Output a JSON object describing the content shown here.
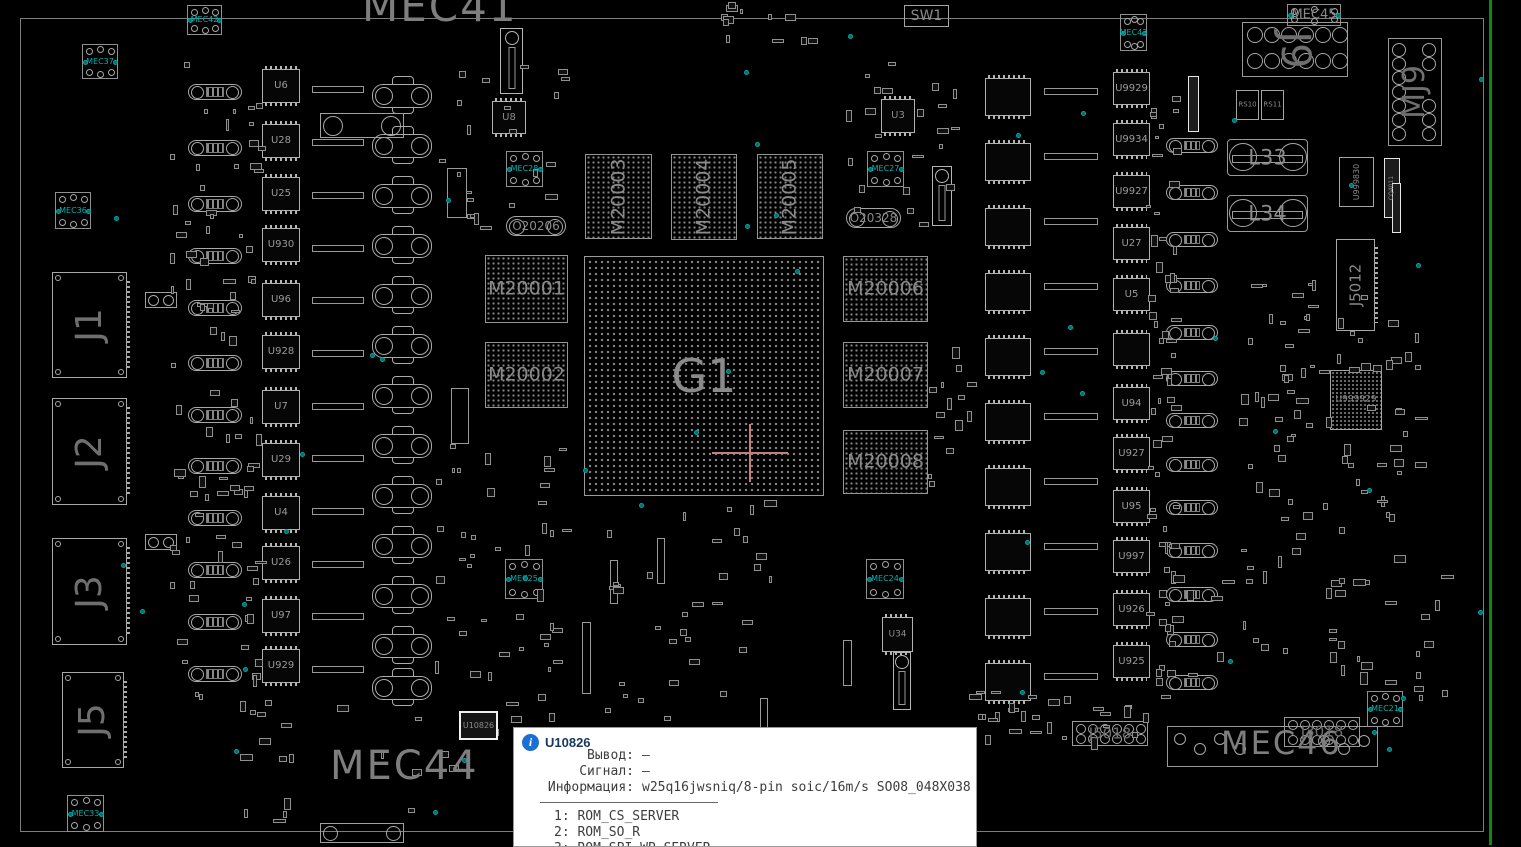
{
  "app": {
    "kind": "pcb-boardview-canvas"
  },
  "colors": {
    "background": "#000000",
    "silkscreen": "#7e7e7e",
    "component_outline": "#a8a8a8",
    "teal_marker": "#00b0b0",
    "board_edge_green": "#0c8a14",
    "crosshair": "#c47e7e",
    "tooltip_bg": "#ffffff",
    "tooltip_title": "#17375e",
    "info_icon_blue": "#1a6fd4"
  },
  "tooltip": {
    "ref": "U10826",
    "fields": [
      {
        "label": "Вывод:",
        "value": "—"
      },
      {
        "label": "Сигнал:",
        "value": "—"
      },
      {
        "label": "Информация:",
        "value": "w25q16jwsniq/8-pin soic/16m/s SO08_048X038"
      }
    ],
    "pins": [
      "1: ROM_CS_SERVER",
      "2: ROM_SO_R",
      "3: ROM_SPI_WP_SERVER"
    ]
  },
  "large_texts": [
    {
      "text": "MEC41",
      "x": 362,
      "y": -14,
      "size": 42
    },
    {
      "text": "MEC44",
      "x": 330,
      "y": 746,
      "size": 40
    },
    {
      "text": "MEC46",
      "x": 1221,
      "y": 727,
      "size": 32
    }
  ],
  "bga": {
    "ref": "G1",
    "x": 584,
    "y": 256,
    "w": 240,
    "h": 240
  },
  "memories": [
    {
      "ref": "M20001",
      "x": 485,
      "y": 255,
      "w": 83,
      "h": 68,
      "vertical": false
    },
    {
      "ref": "M20002",
      "x": 485,
      "y": 342,
      "w": 83,
      "h": 66,
      "vertical": false
    },
    {
      "ref": "M20003",
      "x": 585,
      "y": 154,
      "w": 67,
      "h": 85,
      "vertical": true
    },
    {
      "ref": "M20004",
      "x": 671,
      "y": 154,
      "w": 66,
      "h": 86,
      "vertical": true
    },
    {
      "ref": "M20005",
      "x": 757,
      "y": 154,
      "w": 66,
      "h": 85,
      "vertical": true
    },
    {
      "ref": "M20006",
      "x": 843,
      "y": 256,
      "w": 85,
      "h": 66,
      "vertical": false
    },
    {
      "ref": "M20007",
      "x": 843,
      "y": 342,
      "w": 85,
      "h": 66,
      "vertical": false
    },
    {
      "ref": "M20008",
      "x": 843,
      "y": 430,
      "w": 85,
      "h": 64,
      "vertical": false
    }
  ],
  "connectors_left": [
    {
      "ref": "J1",
      "x": 52,
      "y": 272,
      "w": 75,
      "h": 106
    },
    {
      "ref": "J2",
      "x": 52,
      "y": 398,
      "w": 75,
      "h": 107
    },
    {
      "ref": "J3",
      "x": 52,
      "y": 538,
      "w": 75,
      "h": 107
    },
    {
      "ref": "J5",
      "x": 62,
      "y": 672,
      "w": 62,
      "h": 96
    }
  ],
  "chips_left": {
    "x": 262,
    "w": 38,
    "h": 34,
    "items": [
      {
        "ref": "U6",
        "y": 69
      },
      {
        "ref": "U28",
        "y": 124
      },
      {
        "ref": "U25",
        "y": 177
      },
      {
        "ref": "U930",
        "y": 228
      },
      {
        "ref": "U96",
        "y": 283
      },
      {
        "ref": "U928",
        "y": 335
      },
      {
        "ref": "U7",
        "y": 390
      },
      {
        "ref": "U29",
        "y": 443
      },
      {
        "ref": "U4",
        "y": 496
      },
      {
        "ref": "U26",
        "y": 546
      },
      {
        "ref": "U97",
        "y": 599
      },
      {
        "ref": "U929",
        "y": 649
      }
    ]
  },
  "chips_right": {
    "x": 1113,
    "w": 37,
    "h": 33,
    "items": [
      {
        "ref": "U9929",
        "y": 72
      },
      {
        "ref": "U9934",
        "y": 123
      },
      {
        "ref": "U9927",
        "y": 175
      },
      {
        "ref": "U27",
        "y": 227
      },
      {
        "ref": "U5",
        "y": 278
      },
      {
        "ref": "",
        "y": 333
      },
      {
        "ref": "U94",
        "y": 387
      },
      {
        "ref": "U927",
        "y": 437
      },
      {
        "ref": "U95",
        "y": 490
      },
      {
        "ref": "U997",
        "y": 540
      },
      {
        "ref": "U926",
        "y": 593
      },
      {
        "ref": "U925",
        "y": 645
      }
    ]
  },
  "chips_mid": {
    "x": 985,
    "w": 46,
    "h": 38,
    "ys": [
      78,
      143,
      208,
      273,
      338,
      403,
      468,
      533,
      598,
      663
    ]
  },
  "capsules_left": {
    "x": 188,
    "w": 54,
    "h": 16,
    "ys": [
      84,
      140,
      196,
      248,
      300,
      355,
      407,
      458,
      510,
      562,
      614,
      666
    ]
  },
  "capsules_right": {
    "x": 1166,
    "w": 52,
    "h": 15,
    "ys": [
      138,
      185,
      232,
      278,
      325,
      371,
      413,
      457,
      500,
      543,
      587,
      632,
      675
    ]
  },
  "power_col": {
    "x": 372,
    "w": 60,
    "h": 38,
    "ys": [
      76,
      126,
      176,
      226,
      276,
      326,
      376,
      426,
      476,
      526,
      576,
      626,
      668
    ]
  },
  "hbars": [
    {
      "x": 312,
      "w": 52,
      "ys": [
        86,
        139,
        192,
        245,
        297,
        350,
        403,
        455,
        508,
        561,
        613,
        666
      ]
    },
    {
      "x": 1044,
      "w": 54,
      "ys": [
        88,
        153,
        218,
        283,
        348,
        413,
        478,
        543,
        608,
        673
      ]
    }
  ],
  "mec_boxes": [
    {
      "ref": "MEC42",
      "x": 187,
      "y": 5,
      "w": 35,
      "h": 30
    },
    {
      "ref": "MEC37",
      "x": 82,
      "y": 44,
      "w": 36,
      "h": 35
    },
    {
      "ref": "MEC36",
      "x": 55,
      "y": 192,
      "w": 36,
      "h": 37
    },
    {
      "ref": "MEC33",
      "x": 67,
      "y": 795,
      "w": 37,
      "h": 37
    },
    {
      "ref": "MEC28",
      "x": 506,
      "y": 151,
      "w": 37,
      "h": 36
    },
    {
      "ref": "MEC27",
      "x": 867,
      "y": 151,
      "w": 37,
      "h": 36
    },
    {
      "ref": "MEC43",
      "x": 1120,
      "y": 14,
      "w": 27,
      "h": 37
    },
    {
      "ref": "MEC21",
      "x": 1367,
      "y": 691,
      "w": 36,
      "h": 36
    },
    {
      "ref": "MEC25",
      "x": 505,
      "y": 559,
      "w": 38,
      "h": 40
    },
    {
      "ref": "MEC24",
      "x": 866,
      "y": 559,
      "w": 38,
      "h": 40
    },
    {
      "ref": "MEC45",
      "x": 1287,
      "y": 4,
      "w": 54,
      "h": 22,
      "wide": true
    }
  ],
  "ring_parts": [
    {
      "ref": "J9",
      "x": 1242,
      "y": 22,
      "w": 106,
      "h": 55,
      "style": "grid",
      "fs": 40,
      "rot": true
    },
    {
      "ref": "MJ9",
      "x": 1388,
      "y": 38,
      "w": 54,
      "h": 108,
      "style": "cols",
      "fs": 30,
      "vert": true
    },
    {
      "ref": "J5018",
      "x": 1072,
      "y": 721,
      "w": 76,
      "h": 25,
      "style": "grid2",
      "fs": 15
    },
    {
      "ref": "J3018",
      "x": 1284,
      "y": 717,
      "w": 76,
      "h": 30,
      "style": "grid2",
      "fs": 15
    }
  ],
  "coils": [
    {
      "ref": "L33",
      "x": 1227,
      "y": 139,
      "w": 81,
      "h": 37
    },
    {
      "ref": "L34",
      "x": 1227,
      "y": 195,
      "w": 81,
      "h": 37
    }
  ],
  "named_parts": [
    {
      "ref": "SW1",
      "x": 904,
      "y": 5,
      "w": 45,
      "h": 22,
      "kind": "bx",
      "fs": 14
    },
    {
      "ref": "U8",
      "x": 492,
      "y": 101,
      "w": 34,
      "h": 33,
      "kind": "qfn",
      "fs": 10
    },
    {
      "ref": "U3",
      "x": 881,
      "y": 99,
      "w": 34,
      "h": 34,
      "kind": "qfn",
      "fs": 10
    },
    {
      "ref": "U34",
      "x": 882,
      "y": 617,
      "w": 31,
      "h": 35,
      "kind": "qfn",
      "fs": 9
    },
    {
      "ref": "U10826",
      "x": 459,
      "y": 711,
      "w": 39,
      "h": 29,
      "kind": "sel",
      "fs": 8
    },
    {
      "ref": "O20206",
      "x": 506,
      "y": 216,
      "w": 60,
      "h": 20,
      "kind": "osc",
      "fs": 12
    },
    {
      "ref": "O20328",
      "x": 846,
      "y": 208,
      "w": 55,
      "h": 20,
      "kind": "osc",
      "fs": 12
    },
    {
      "ref": "RS10",
      "x": 1236,
      "y": 90,
      "w": 23,
      "h": 30,
      "kind": "bx",
      "fs": 7
    },
    {
      "ref": "RS11",
      "x": 1261,
      "y": 90,
      "w": 23,
      "h": 30,
      "kind": "bx",
      "fs": 7
    },
    {
      "ref": "U999830",
      "x": 1339,
      "y": 157,
      "w": 35,
      "h": 50,
      "kind": "vbox",
      "fs": 8
    },
    {
      "ref": "J5012",
      "x": 1336,
      "y": 239,
      "w": 39,
      "h": 92,
      "kind": "vconnbig",
      "fs": 15
    },
    {
      "ref": "U999929",
      "x": 1330,
      "y": 370,
      "w": 52,
      "h": 60,
      "kind": "bgachip",
      "fs": 9
    },
    {
      "ref": "CQ4011",
      "x": 1384,
      "y": 158,
      "w": 16,
      "h": 60,
      "kind": "vbright",
      "fs": 6
    }
  ],
  "mec46_box": {
    "x": 1167,
    "y": 726,
    "w": 211,
    "h": 41
  },
  "vbars": [
    [
      500,
      28,
      23,
      66,
      "vconn"
    ],
    [
      932,
      166,
      20,
      60,
      "vconn"
    ],
    [
      893,
      652,
      18,
      58,
      "vconn"
    ],
    [
      447,
      168,
      20,
      50,
      "vplain"
    ],
    [
      451,
      388,
      18,
      56,
      "vplain"
    ],
    [
      1188,
      76,
      11,
      56,
      "vbright"
    ],
    [
      1392,
      183,
      9,
      50,
      "vbright"
    ],
    [
      582,
      622,
      9,
      72,
      "vplain"
    ],
    [
      610,
      560,
      8,
      44,
      "vplain"
    ],
    [
      657,
      538,
      8,
      46,
      "vplain"
    ],
    [
      843,
      640,
      9,
      46,
      "vplain"
    ],
    [
      760,
      698,
      8,
      36,
      "vplain"
    ]
  ],
  "dual_circles": [
    [
      145,
      292,
      32,
      16
    ],
    [
      145,
      534,
      32,
      16
    ],
    [
      320,
      113,
      84,
      25
    ],
    [
      320,
      823,
      84,
      20
    ]
  ],
  "board_outline": {
    "x": 20,
    "y": 18,
    "w": 1464,
    "h": 814
  },
  "green_line": {
    "x": 1489,
    "y": 0,
    "w": 3,
    "h": 845
  },
  "crosshair": {
    "x": 750,
    "y": 453,
    "arm_h": 38,
    "arm_v": 29
  },
  "clusters": [
    [
      168,
      60,
      92,
      640,
      85
    ],
    [
      1146,
      60,
      28,
      640,
      60
    ],
    [
      432,
      440,
      130,
      290,
      45
    ],
    [
      600,
      500,
      190,
      230,
      35
    ],
    [
      1238,
      275,
      180,
      290,
      80
    ],
    [
      830,
      55,
      130,
      185,
      22
    ],
    [
      438,
      55,
      125,
      185,
      22
    ],
    [
      962,
      690,
      190,
      50,
      30
    ],
    [
      1150,
      560,
      300,
      140,
      40
    ],
    [
      690,
      2,
      130,
      38,
      12
    ],
    [
      240,
      690,
      220,
      130,
      20
    ],
    [
      928,
      330,
      45,
      180,
      14
    ]
  ],
  "teal_dots": {
    "count": 46,
    "area": [
      30,
      25,
      1450,
      800
    ]
  }
}
